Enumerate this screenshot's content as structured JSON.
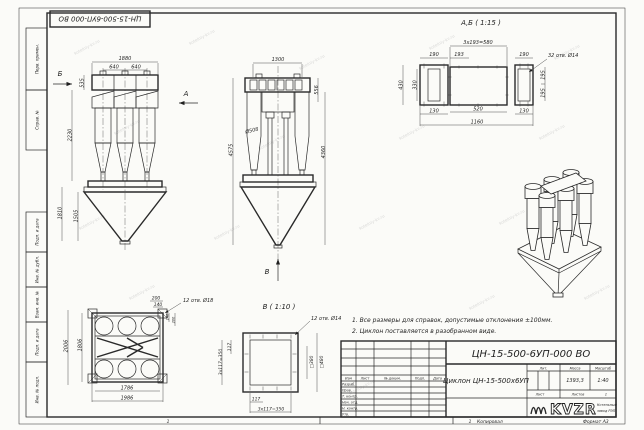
{
  "colors": {
    "paper": "#fbfbf8",
    "line": "#2a2a2a",
    "watermark": "#c0c0c0"
  },
  "watermark": {
    "text": "kotelniy-kv.ru"
  },
  "stamp": {
    "doc_number": "ЦН-15-500-6УП-000 ВО"
  },
  "margin": {
    "labels": [
      "Перв. примен.",
      "Справ. №",
      "Подп. и дата",
      "Инв. № дубл.",
      "Взам. инв. №",
      "Подп. и дата",
      "Инв. № подл."
    ]
  },
  "views": {
    "front": {
      "dim_1880": "1880",
      "dim_640a": "640",
      "dim_640b": "640",
      "dim_535": "535",
      "dim_2230": "2230",
      "dim_1810": "1810",
      "dim_1505": "1505",
      "arrow_a": "А",
      "arrow_b": "Б"
    },
    "side": {
      "dim_1300": "1300",
      "dim_556": "556",
      "dim_d508": "Ø508",
      "dim_4575": "4575",
      "dim_4360": "4360",
      "arrow_v": "В"
    },
    "detail_ab": {
      "title": "А,Б ( 1:15 )",
      "dim_step": "3x193=580",
      "dim_190a": "190",
      "dim_193": "193",
      "dim_190b": "190",
      "holes": "32 отв. Ø14",
      "dim_430": "430",
      "dim_330": "330",
      "dim_195a": "195",
      "dim_195b": "195",
      "dim_130a": "130",
      "dim_520": "520",
      "dim_130b": "130",
      "dim_1160": "1160"
    },
    "plan": {
      "dim_200a": "200",
      "dim_140a": "140",
      "holes": "12 отв. Ø18",
      "dim_140b": "140",
      "dim_200b": "200",
      "dim_2006": "2006",
      "dim_1806": "1806",
      "dim_1786": "1786",
      "dim_1986": "1986"
    },
    "view_v": {
      "title": "В ( 1:10 )",
      "holes": "12 отв. Ø14",
      "dim_117l": "117",
      "dim_350l": "3х117=350",
      "dim_sq380": "□380",
      "dim_sq480": "□480",
      "dim_117b": "117",
      "dim_350b": "3х117=350"
    }
  },
  "notes": {
    "line1": "1. Все размеры для справок, допустимые отклонения ±100мм.",
    "line2": "2. Циклон поставляется в разобранном виде."
  },
  "title_block": {
    "doc_number": "ЦН-15-500-6УП-000 ВО",
    "product_name": "Циклон ЦН-15-500х6УП",
    "col_izm": "Изм",
    "col_list": "Лист",
    "col_doc": "№ докум.",
    "col_podp": "Подп.",
    "col_data": "Дата",
    "rows": [
      "Разраб.",
      "Пров.",
      "Т. контр.",
      "Нач. отд.",
      "Н. контр.",
      "Утв."
    ],
    "lit_label": "Лит.",
    "mass_label": "Масса",
    "scale_label": "Масштаб",
    "mass_value": "1393,3",
    "scale_value": "1:40",
    "sheet_label": "Лист",
    "sheets_label": "Листов",
    "sheets_value": "1",
    "logo_text": "KVZR",
    "company_line1": "Котельный",
    "company_line2": "завод РЭП"
  },
  "footer": {
    "copied": "Копировал",
    "format": "Формат А3",
    "mark1": "1",
    "mark2": "1"
  }
}
